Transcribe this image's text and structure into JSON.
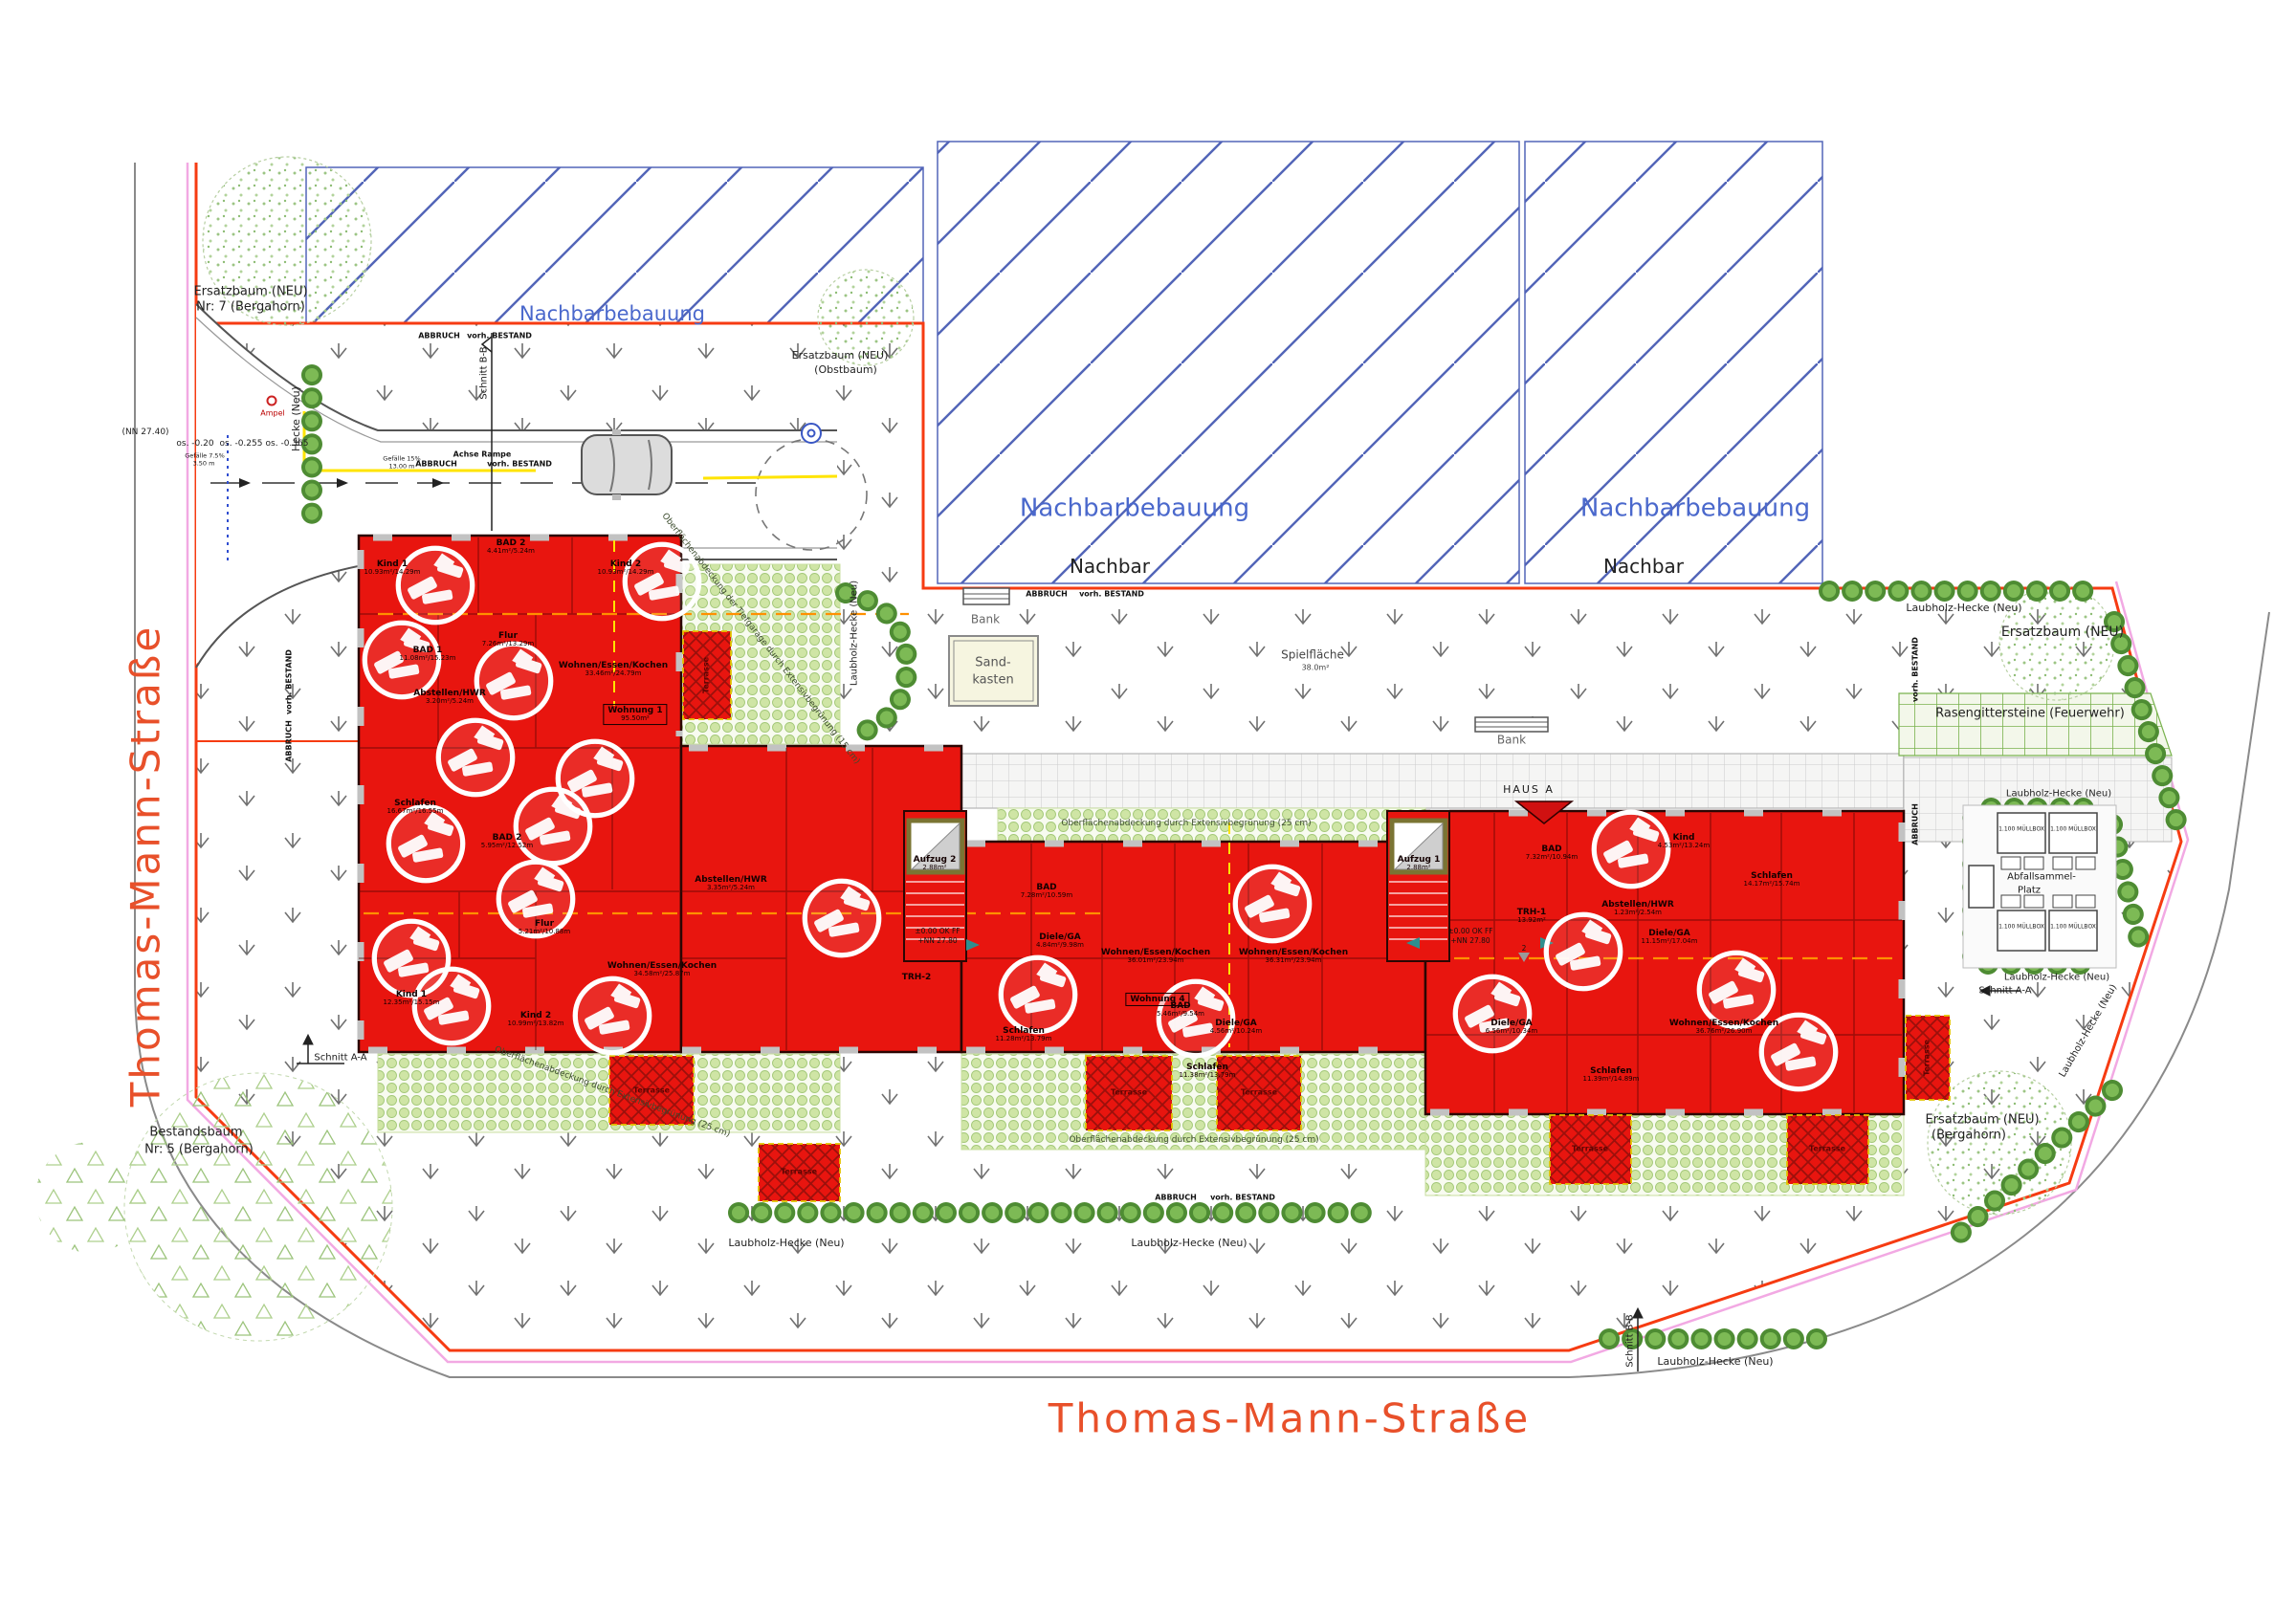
{
  "colors": {
    "building_red": "#e8150f",
    "boundary_orange": "#f63b12",
    "hatch_blue": "#5265b8",
    "hedge_green": "#4e8c33",
    "street_pink": "#f2a9e3",
    "marking_yellow": "#ffe400"
  },
  "streets": {
    "name": "Thomas-Mann-Straße"
  },
  "neighbor": {
    "area": "Nachbarbebauung",
    "edge": "Nachbar"
  },
  "sections": {
    "aa": "Schnitt A-A",
    "bb": "Schnitt B-B"
  },
  "marks": {
    "abbruch": "ABBRUCH",
    "bestand": "vorh. BESTAND",
    "achse": "Achse Rampe",
    "ampel": "Ampel",
    "nn": "(NN 27.40)",
    "os1": "os. -0.20",
    "os2": "os. -0.255",
    "os3": "os. -0.365",
    "gef1": "Gefälle 7.5%",
    "gef1m": "3.50 m",
    "gef2": "Gefälle 15%",
    "gef2m": "13.00 m",
    "level": "±0.00 OK FF",
    "level_nn": "+NN 27.80",
    "haus_a": "HAUS A",
    "two": "2"
  },
  "green": {
    "hecke": "Hecke (Neu)",
    "laubhecke": "Laubholz-Hecke (Neu)",
    "rasengitter": "Rasengittersteine (Feuerwehr)",
    "ersatzbaum": "Ersatzbaum (NEU)",
    "nr7": "Nr: 7 (Bergahorn)",
    "obstbaum": "(Obstbaum)",
    "bergahorn": "(Bergahorn)",
    "bestandsbaum": "Bestandsbaum",
    "nr5": "Nr: 5 (Bergahorn)",
    "gruen15": "Oberflächenabdeckung der Tiefgarage durch Extensivbegrünung (15 cm)",
    "gruen25": "Oberflächenabdeckung durch Extensivbegrünung (25 cm)"
  },
  "amenities": {
    "bank": "Bank",
    "sand1": "Sand-",
    "sand2": "kasten",
    "spiel": "Spielfläche",
    "spiel_area": "38.0m²",
    "abfall1": "Abfallsammel-",
    "abfall2": "Platz",
    "muellbox": "1.100 MÜLLBOX"
  },
  "building": {
    "aufzug1": "Aufzug 1",
    "aufzug2": "Aufzug 2",
    "aufzug_area": "2.88m²",
    "trh1": "TRH-1",
    "trh1_area": "13.92m²",
    "trh2": "TRH-2",
    "terrasse": "Terrasse"
  },
  "flats": {
    "w1": "Wohnung 1",
    "w1a": "95.50m²",
    "w4": "Wohnung 4"
  },
  "rooms": [
    {
      "n": "Kind 1",
      "a": "10.93m²/14.29m"
    },
    {
      "n": "BAD 2",
      "a": "4.41m²/5.24m"
    },
    {
      "n": "Kind 2",
      "a": "10.93m²/14.29m"
    },
    {
      "n": "BAD 1",
      "a": "11.08m²/15.23m"
    },
    {
      "n": "Flur",
      "a": "7.26m²/13.29m"
    },
    {
      "n": "Abstellen/HWR",
      "a": "3.20m²/5.24m"
    },
    {
      "n": "Wohnen/Essen/Kochen",
      "a": "33.46m²/24.79m"
    },
    {
      "n": "Schlafen",
      "a": "16.67m²/16.55m"
    },
    {
      "n": "BAD 2",
      "a": "5.95m²/12.52m"
    },
    {
      "n": "Flur",
      "a": "5.21m²/10.88m"
    },
    {
      "n": "Kind 1",
      "a": "12.35m²/15.15m"
    },
    {
      "n": "Kind 2",
      "a": "10.99m²/13.82m"
    },
    {
      "n": "Wohnen/Essen/Kochen",
      "a": "34.58m²/25.87m"
    },
    {
      "n": "Abstellen/HWR",
      "a": "3.35m²/5.24m"
    },
    {
      "n": "Diele/GA",
      "a": "4.84m²/9.98m"
    },
    {
      "n": "BAD",
      "a": "7.28m²/10.59m"
    },
    {
      "n": "Schlafen",
      "a": "11.28m²/13.79m"
    },
    {
      "n": "Wohnen/Essen/Kochen",
      "a": "36.01m²/23.94m"
    },
    {
      "n": "Wohnen/Essen/Kochen",
      "a": "36.31m²/23.94m"
    },
    {
      "n": "Schlafen",
      "a": "11.38m²/13.79m"
    },
    {
      "n": "BAD",
      "a": "5.46m²/9.54m"
    },
    {
      "n": "Diele/GA",
      "a": "4.56m²/10.24m"
    },
    {
      "n": "Kind",
      "a": "4.53m²/13.24m"
    },
    {
      "n": "Abstellen/HWR",
      "a": "1.23m²/2.54m"
    },
    {
      "n": "Diele/GA",
      "a": "11.15m²/17.04m"
    },
    {
      "n": "Schlafen",
      "a": "14.17m²/15.74m"
    },
    {
      "n": "Wohnen/Essen/Kochen",
      "a": "36.76m²/26.90m"
    },
    {
      "n": "Schlafen",
      "a": "11.39m²/14.89m"
    },
    {
      "n": "BAD",
      "a": "7.32m²/10.94m"
    },
    {
      "n": "Diele/GA",
      "a": "6.56m²/10.34m"
    }
  ]
}
